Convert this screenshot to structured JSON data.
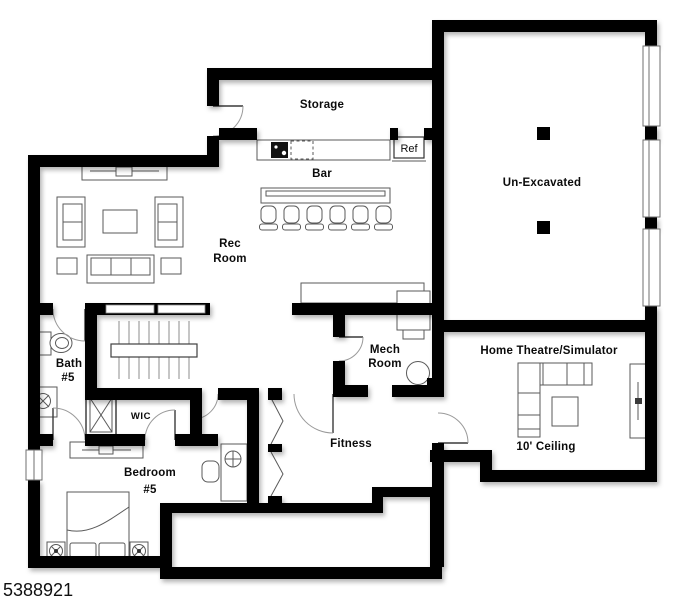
{
  "listing_number": "5388921",
  "rooms": {
    "storage": {
      "label": "Storage"
    },
    "bar": {
      "label": "Bar"
    },
    "rec_room": {
      "line1": "Rec",
      "line2": "Room"
    },
    "un_excavated": {
      "label": "Un-Excavated"
    },
    "bath_5": {
      "line1": "Bath",
      "line2": "#5"
    },
    "wic": {
      "label": "WIC"
    },
    "mech_room": {
      "line1": "Mech",
      "line2": "Room"
    },
    "home_theatre": {
      "label": "Home Theatre/Simulator",
      "ceiling_note": "10' Ceiling"
    },
    "bedroom_5": {
      "line1": "Bedroom",
      "line2": "#5"
    },
    "fitness": {
      "label": "Fitness"
    }
  },
  "appliances": {
    "refrigerator_label": "Ref"
  },
  "colors": {
    "wall": "#000000",
    "background": "#ffffff",
    "furniture_line": "#5a5a5a"
  }
}
